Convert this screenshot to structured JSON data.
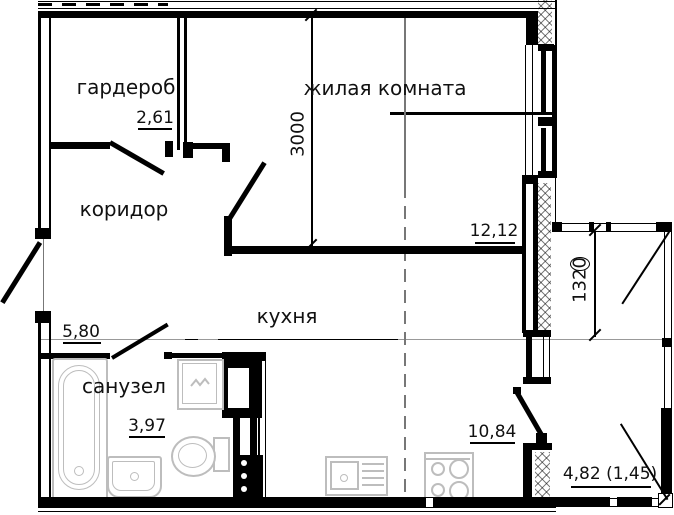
{
  "plan": {
    "rooms": [
      {
        "name": "гардероб",
        "area": "2,61"
      },
      {
        "name": "жилая комната",
        "area": "12,12"
      },
      {
        "name": "коридор",
        "area": "5,80"
      },
      {
        "name": "кухня",
        "area": "10,84"
      },
      {
        "name": "санузел",
        "area": "3,97"
      }
    ],
    "balcony": {
      "area": "4,82 (1,45)"
    },
    "dimensions": {
      "room_depth_mm": "3000",
      "balcony_depth_mm": "1320"
    },
    "fixtures": [
      "bathtub",
      "sink",
      "toilet",
      "washing-machine",
      "kitchen-sink",
      "stove",
      "vent-shaft"
    ],
    "colors": {
      "wall": "#000000",
      "fixture": "#bdbdbd",
      "axis": "#777777"
    }
  }
}
